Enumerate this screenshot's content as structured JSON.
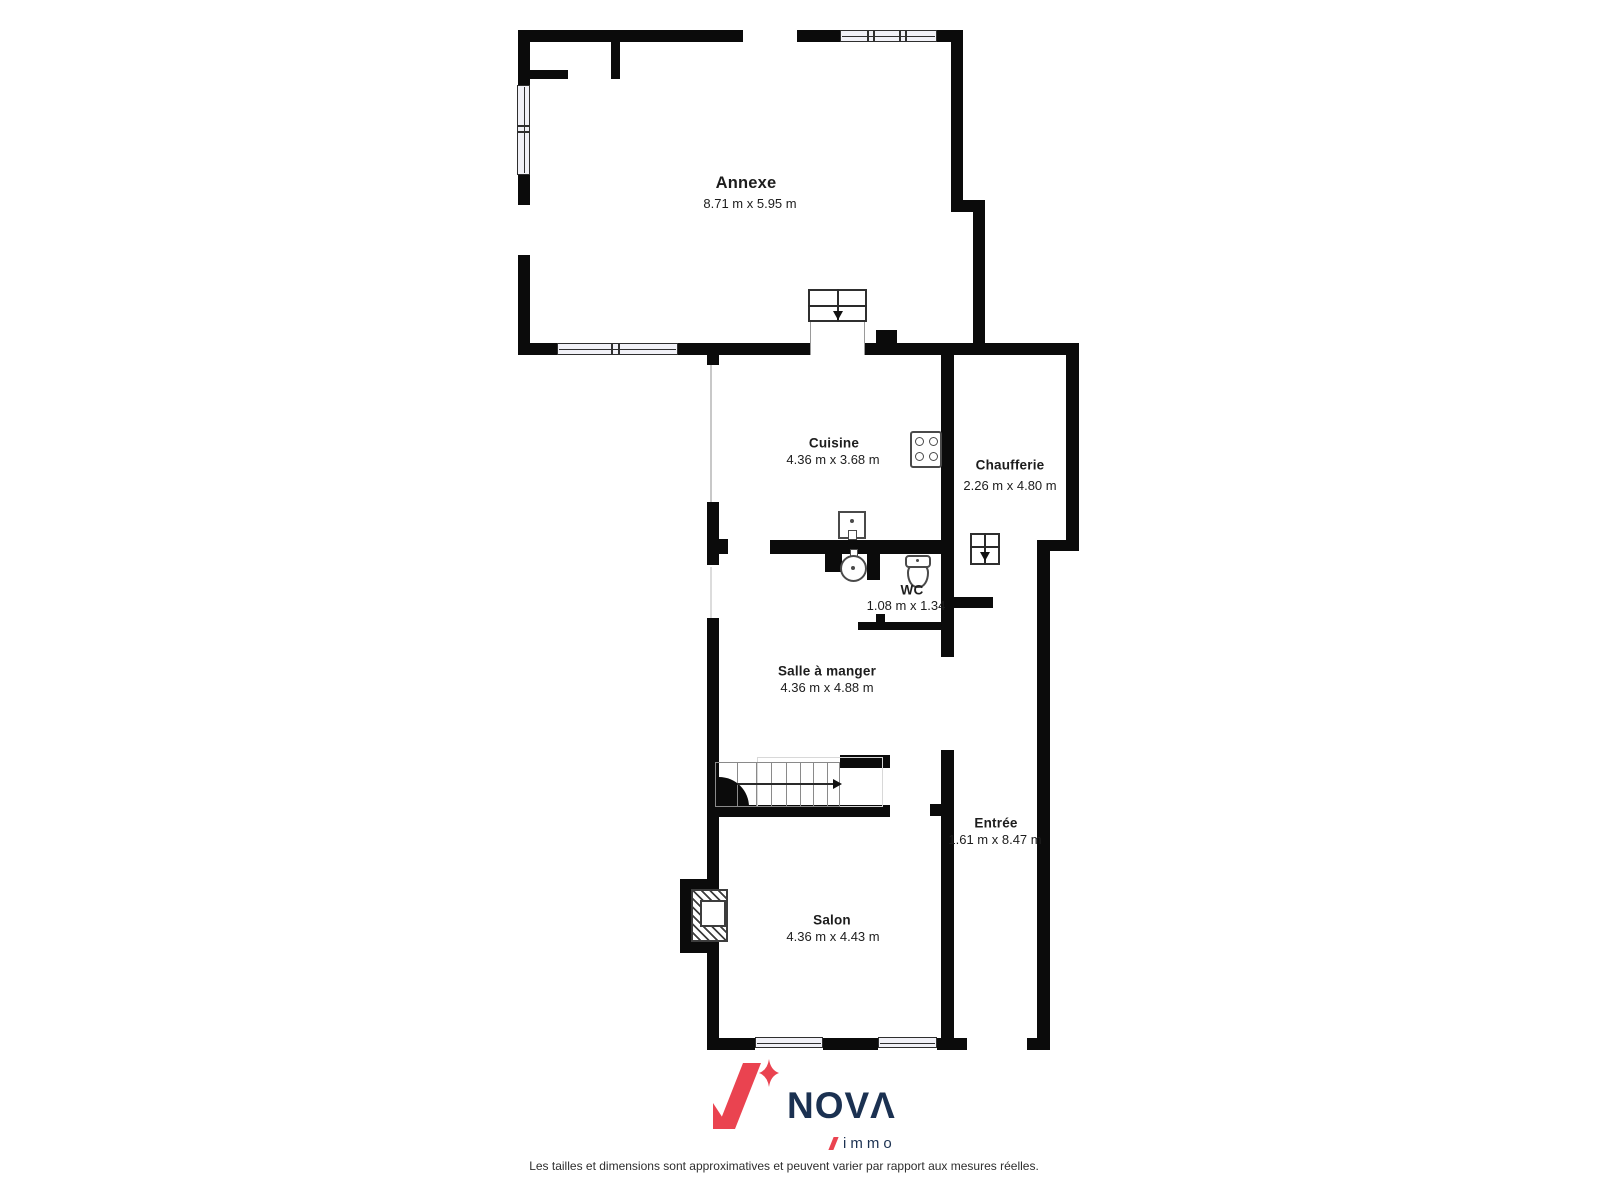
{
  "rooms": {
    "annexe": {
      "name": "Annexe",
      "dims": "8.71 m x 5.95 m"
    },
    "cuisine": {
      "name": "Cuisine",
      "dims": "4.36 m x 3.68 m"
    },
    "chaufferie": {
      "name": "Chaufferie",
      "dims": "2.26 m x 4.80 m"
    },
    "wc": {
      "name": "WC",
      "dims": "1.08 m x 1.34"
    },
    "salle_a_manger": {
      "name": "Salle à manger",
      "dims": "4.36 m x 4.88 m"
    },
    "entree": {
      "name": "Entrée",
      "dims": "1.61 m x 8.47 m"
    },
    "salon": {
      "name": "Salon",
      "dims": "4.36 m x 4.43 m"
    }
  },
  "icons": {
    "stove": "stove-icon",
    "kitchen_sink": "sink-icon",
    "washbasin": "washbasin-icon",
    "toilet": "toilet-icon",
    "fireplace": "fireplace-icon",
    "staircase": "staircase-icon",
    "steps_down_annexe": "steps-down-icon",
    "steps_down_chaufferie": "steps-down-icon",
    "windows": "window-icon"
  },
  "branding": {
    "name": "NOVΛ",
    "sub": "immo",
    "colors": {
      "red": "#ea4350",
      "navy": "#1b3151"
    }
  },
  "footer": {
    "disclaimer": "Les tailles et dimensions sont approximatives et peuvent varier par rapport aux mesures réelles."
  }
}
